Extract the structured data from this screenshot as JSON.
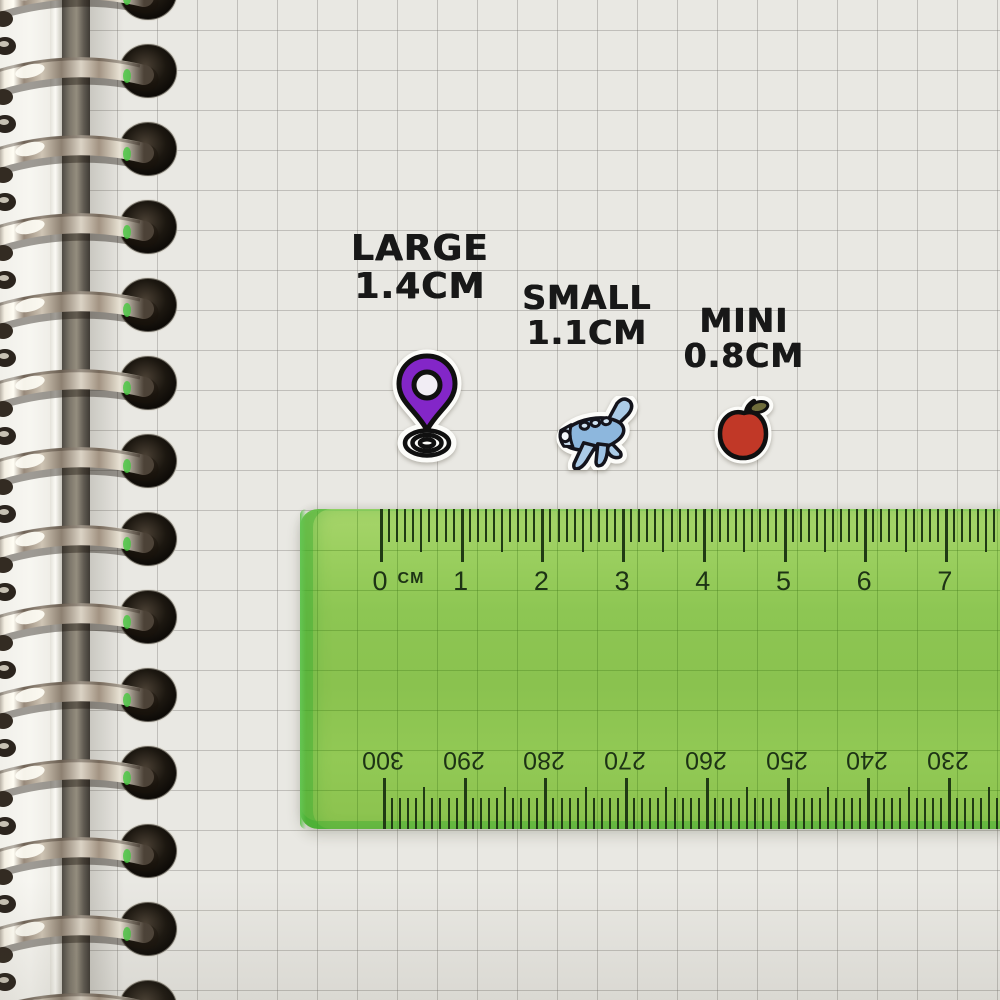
{
  "stickers": [
    {
      "label": "LARGE",
      "size": "1.4CM",
      "icon": "location-pin-icon"
    },
    {
      "label": "SMALL",
      "size": "1.1CM",
      "icon": "airplane-icon"
    },
    {
      "label": "MINI",
      "size": "0.8CM",
      "icon": "apple-icon"
    }
  ],
  "ruler": {
    "unit": "CM",
    "top_scale": [
      "0",
      "1",
      "2",
      "3",
      "4",
      "5",
      "6",
      "7"
    ],
    "bottom_scale": [
      "300",
      "290",
      "280",
      "270",
      "260",
      "250",
      "240",
      "230"
    ]
  },
  "binding": {
    "ring_count": 14
  },
  "colors": {
    "paper": "#e9e8e3",
    "grid_line": "#b5b3ae",
    "label_ink": "#181818",
    "ruler_green": "#8cc551",
    "ruler_edge_green": "#44b13e",
    "ruler_ink": "#1d3315",
    "pin_purple": "#8326c8",
    "plane_blue": "#8db7dd",
    "apple_red": "#c13827",
    "binding_metal": "#cfc5b5",
    "punch_hole": "#141009"
  }
}
